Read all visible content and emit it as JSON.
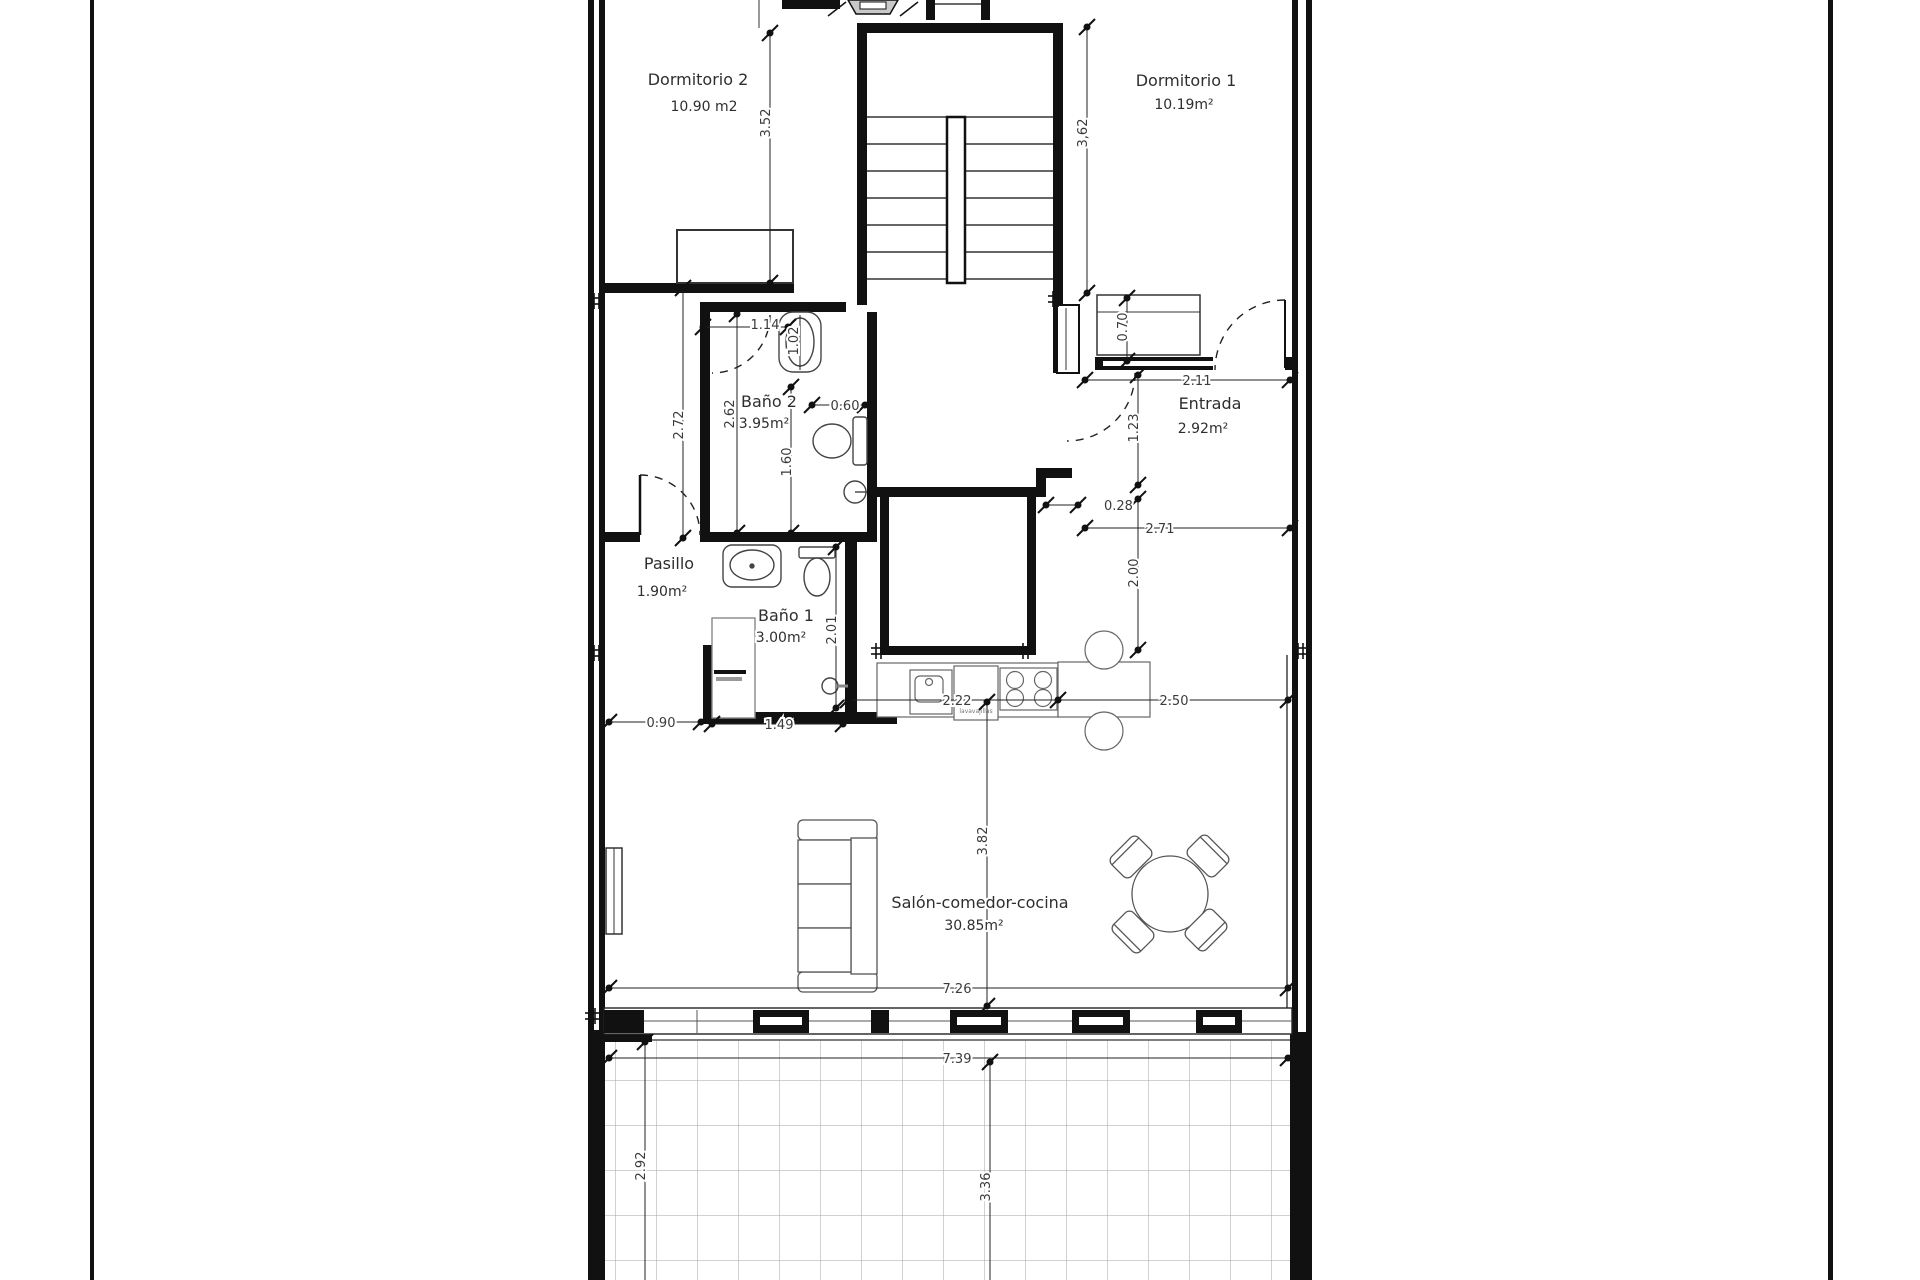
{
  "title": "Apartment floor plan",
  "rooms": {
    "dormitorio2": {
      "name": "Dormitorio 2",
      "area": "10.90 m2"
    },
    "dormitorio1": {
      "name": "Dormitorio 1",
      "area": "10.19m²"
    },
    "bano2": {
      "name": "Baño 2",
      "area": "3.95m²"
    },
    "entrada": {
      "name": "Entrada",
      "area": "2.92m²"
    },
    "pasillo": {
      "name": "Pasillo",
      "area": "1.90m²"
    },
    "bano1": {
      "name": "Baño 1",
      "area": "3.00m²"
    },
    "salon": {
      "name": "Salón-comedor-cocina",
      "area": "30.85m²"
    }
  },
  "dimensions": {
    "dorm2_depth": "3.52",
    "dorm1_depth": "3,62",
    "wardrobe_depth": "0.70",
    "entrada_width": "2.11",
    "entry_offset": "1.23",
    "wall_stub": "0.28",
    "hall_width": "2.71",
    "hall_depth": "2.00",
    "bano2_shelf": "1.14",
    "bano2_fixture": "1.02",
    "pasillo_depth": "2.72",
    "bano2_depth": "2.62",
    "bano2_inner": "1.60",
    "bano2_toilet": "0.60",
    "bano1_depth": "2.01",
    "bano1_door": "0.90",
    "bano1_width": "1.49",
    "kitchen_run": "2.22",
    "kitchen_to_wall": "2.50",
    "salon_depth": "3.82",
    "salon_width": "7.26",
    "terrace_width": "7.39",
    "terrace_depth_left": "2.92",
    "terrace_depth_right": "3.36"
  },
  "fixtures": {
    "dishwasher_label": "lavavajillas"
  },
  "colors": {
    "wall": "#111111",
    "dim_line": "#222222",
    "dim_text": "#3b3b3b",
    "grid": "#a3a3a3",
    "door_leaf_fill": "#c9c9c9"
  }
}
